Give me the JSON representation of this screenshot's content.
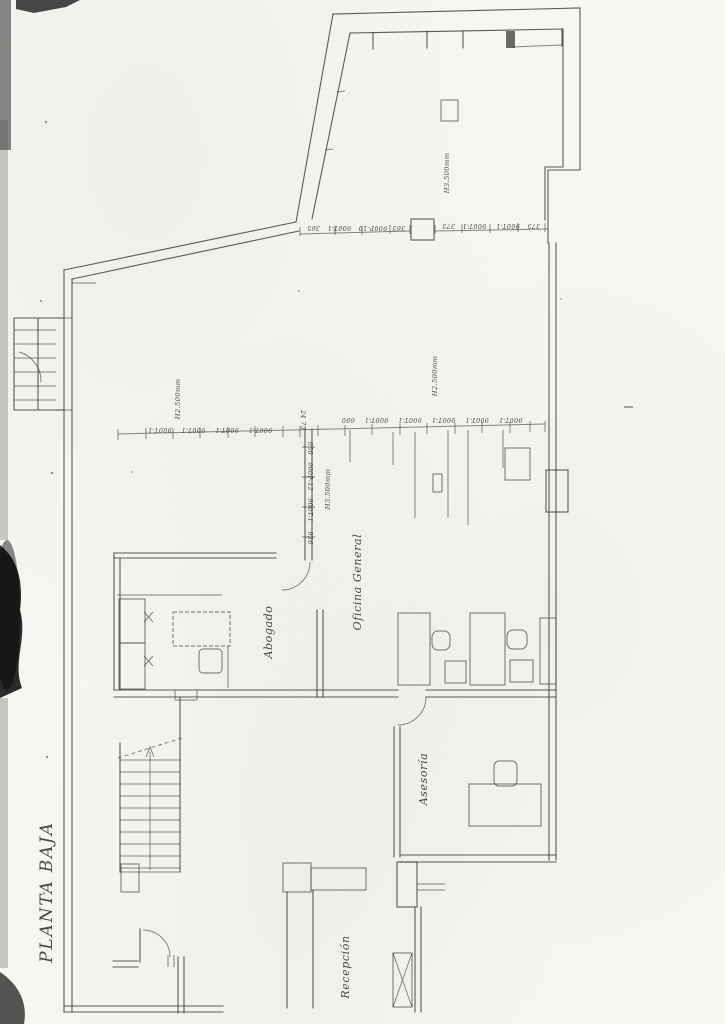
{
  "page": {
    "kind": "scanned architectural floor plan",
    "title": "PLANTA BAJA"
  },
  "rooms": {
    "abogado": "Abogado",
    "oficina_general": "Oficina General",
    "asesoria": "Asesoría",
    "recepcion": "Recepción"
  },
  "heights": {
    "top_room": "H3.500mm",
    "hall_left": "H2.500mm",
    "hall_right": "H2.500mm",
    "inner_wall": "H3.500mm"
  },
  "dims": {
    "top_left": "365  900P-10   900T-1   365",
    "top_right": "375   900T-1    900T-1   375",
    "mid_left": "900T-1    900T-1    900T-1    900T-1",
    "mid_left_end": "24 75",
    "mid_right": "900T-1    900T-1    900T-1    900T-1    900T-1    690",
    "wall_vertical": "950   900P-12   900T-1",
    "wall_vertical_end": "936"
  },
  "colors": {
    "paper": "#f7f6f2",
    "ink": "#3b3833",
    "scan_artifact": "#161616"
  }
}
